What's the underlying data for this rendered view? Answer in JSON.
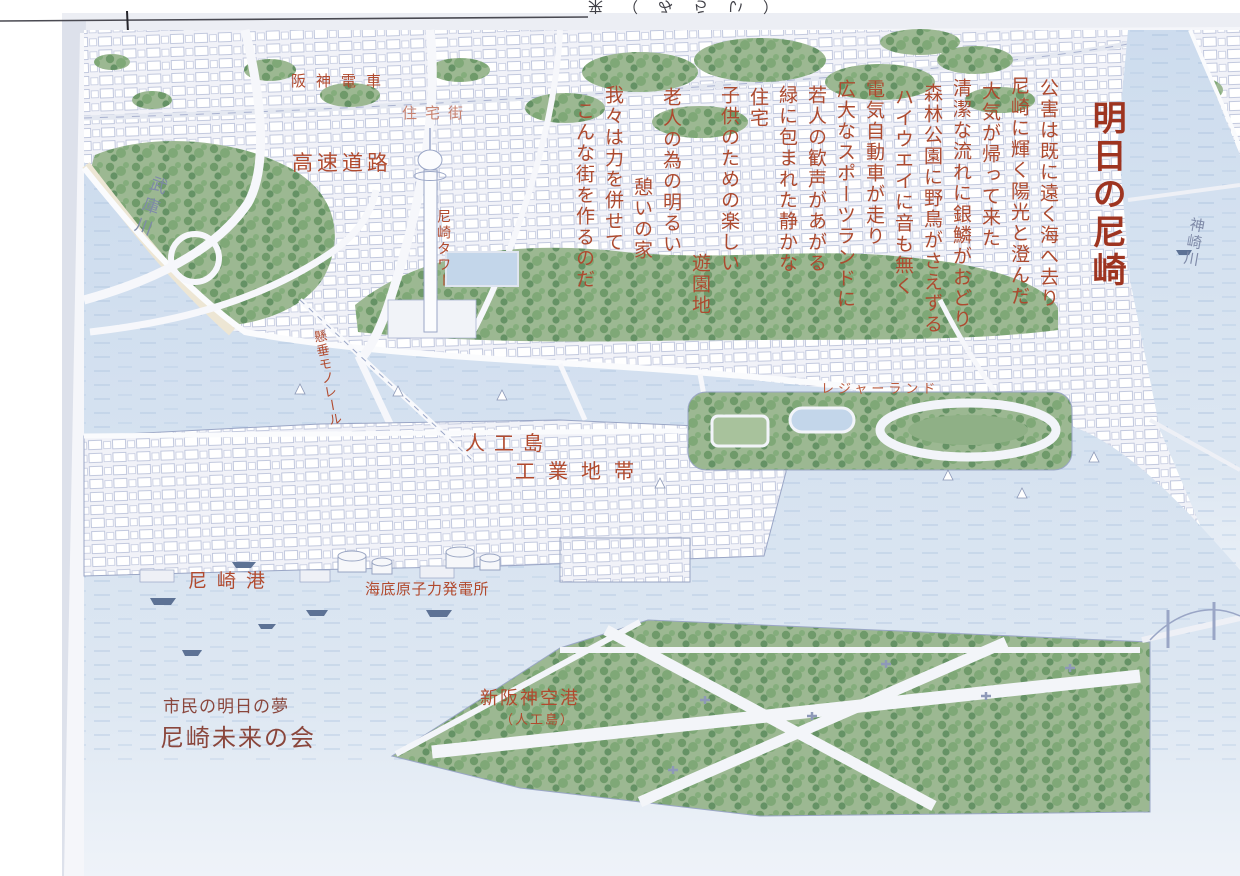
{
  "title": "明日の尼崎",
  "poem": {
    "columns": [
      "公害は既に遠く海へ去り",
      "尼崎に輝く陽光と澄んだ",
      "大気が帰って来た",
      "清潔な流れに銀鱗がおどり",
      "森林公園に野鳥がさえずる",
      "ハイウエイに音も無く",
      "電気自動車が走り",
      "広大なスポーツランドに",
      "若人の歓声があがる",
      "緑に包まれた静かな",
      "住宅",
      "子供のための楽しい",
      "遊園地",
      "老人の為の明るい",
      "憩いの家",
      "我々は力を併せて",
      "こんな街を作るのだ"
    ]
  },
  "labels": {
    "hanshin_densha": "阪神電車",
    "jutakugai": "住宅街",
    "kosoku_doro": "高速道路",
    "mukogawa": "武庫川",
    "amagasaki_tower": "尼崎タワー",
    "monorail": "懸垂モノレール",
    "kanzakigawa": "神崎川",
    "leisure_land": "レジャーランド",
    "jinko_jima": "人工島",
    "kogyo_chitai": "工業地帯",
    "amagasaki_ko": "尼崎港",
    "kaitei_genshiryoku_hatsudensho": "海底原子力発電所",
    "shin_hanshin_kuko": "新阪神空港",
    "shin_hanshin_kuko_note": "（人工島）"
  },
  "credit": {
    "subtitle": "市民の明日の夢",
    "organization": "尼崎未来の会"
  },
  "scan": {
    "top_edge_text": "来（みらい）"
  },
  "colors": {
    "label_red": "#b14a2e",
    "title_red": "#9e3420",
    "credit_red": "#8a463c",
    "river_label_blue": "#7f8aa8",
    "ink_blue": "#a9b2d0",
    "water_blue": "#cfddee",
    "park_green": "#85a47c",
    "paper": "#f5f6fa"
  }
}
